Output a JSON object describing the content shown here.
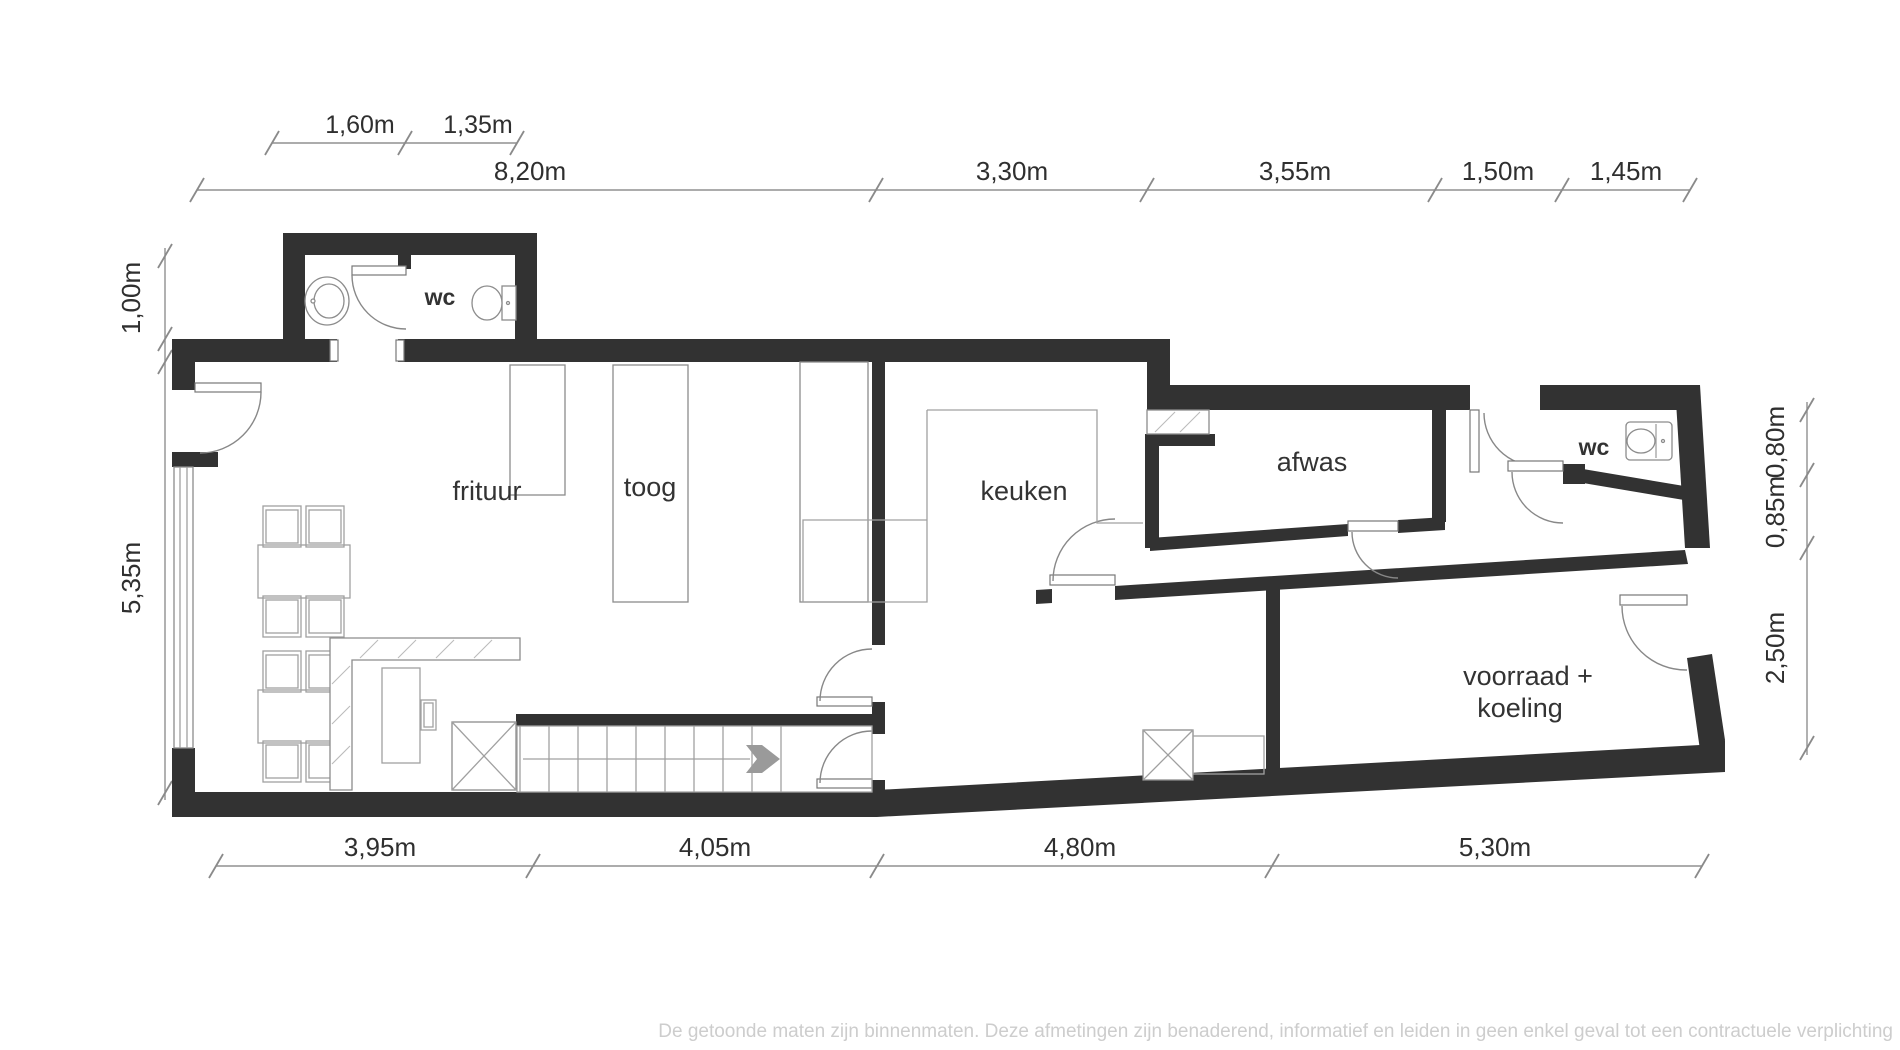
{
  "rooms": {
    "wc_top": "wc",
    "frituur": "frituur",
    "toog": "toog",
    "keuken": "keuken",
    "afwas": "afwas",
    "wc_right": "wc",
    "voorraad_line1": "voorraad +",
    "voorraad_line2": "koeling"
  },
  "dims": {
    "top_small": [
      "1,60m",
      "1,35m"
    ],
    "top": [
      "8,20m",
      "3,30m",
      "3,55m",
      "1,50m",
      "1,45m"
    ],
    "left": [
      "1,00m",
      "5,35m"
    ],
    "right": [
      "0,80m",
      "0,85m",
      "2,50m"
    ],
    "bottom": [
      "3,95m",
      "4,05m",
      "4,80m",
      "5,30m"
    ]
  },
  "footer": {
    "disclaimer": "De getoonde maten zijn binnenmaten. Deze afmetingen zijn benaderend, informatief en leiden in geen enkel geval tot een contractuele verplichting"
  },
  "colors": {
    "wall": "#323232",
    "dimension_line": "#909090",
    "furniture_line": "#a0a0a0",
    "label": "#333333",
    "footer": "#cdcdcd"
  }
}
